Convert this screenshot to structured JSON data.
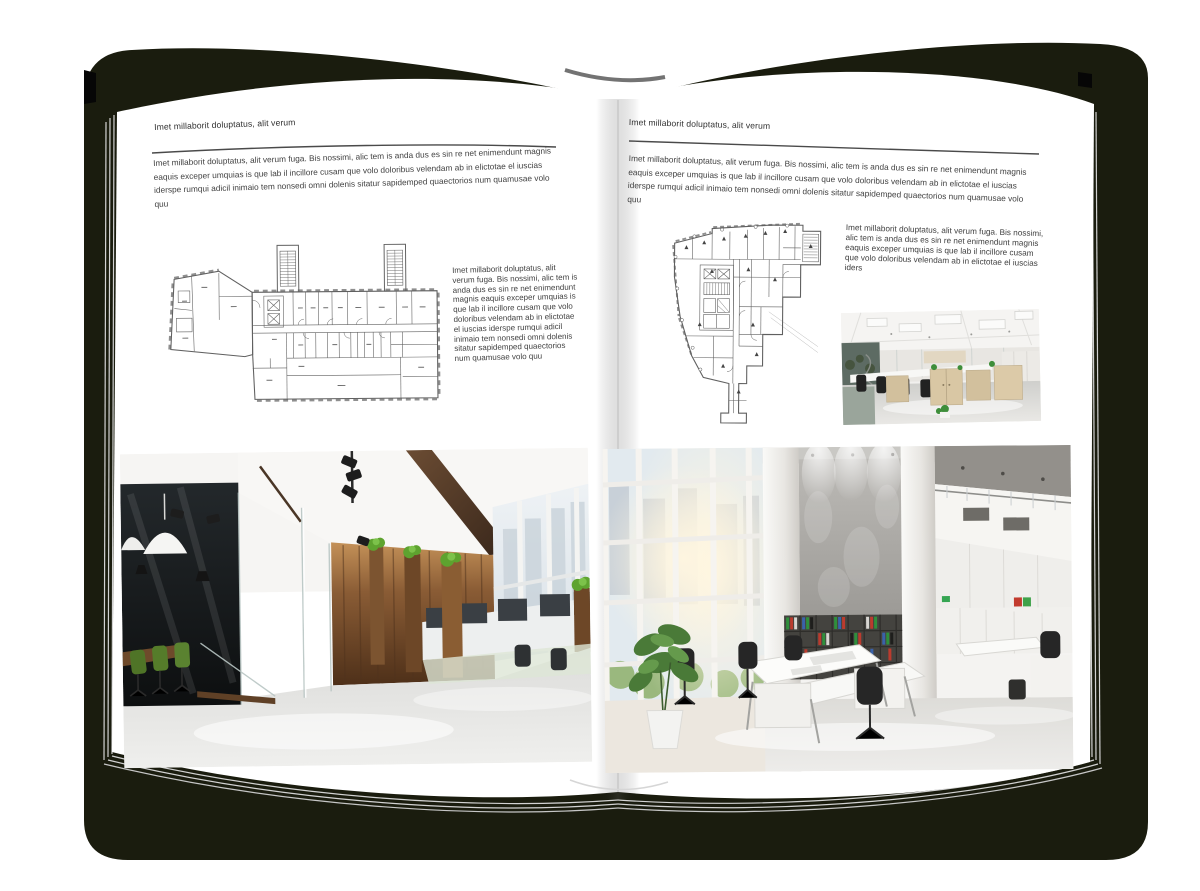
{
  "pages": {
    "left": {
      "header": "Imet millaborit doluptatus, alit verum",
      "intro": "Imet millaborit doluptatus, alit verum fuga. Bis nossimi, alic tem is anda dus es sin re net enimendunt magnis eaquis exceper umquias is que lab il incillore cusam que volo doloribus velendam ab in elictotae el iuscias iderspe rumqui adicil inimaio tem nonsedi omni dolenis sitatur sapidemped quaectorios num quamusae volo quu",
      "plan_caption": "Imet millaborit doluptatus, alit verum fuga. Bis nossimi, alic tem is anda dus es sin re net enimendunt magnis eaquis exceper umquias is que lab il incillore cusam que volo doloribus velendam ab in elictotae el iuscias iderspe rumqui adicil inimaio tem nonsedi omni dolenis sitatur sapidemped quaectorios num quamusae volo quu"
    },
    "right": {
      "header": "Imet millaborit doluptatus, alit verum",
      "intro": "Imet millaborit doluptatus, alit verum fuga. Bis nossimi, alic tem is anda dus es sin re net enimendunt magnis eaquis exceper umquias is que lab il incillore cusam que volo doloribus velendam ab in elictotae el iuscias iderspe rumqui adicil inimaio tem nonsedi omni dolenis sitatur sapidemped quaectorios num quamusae volo quu",
      "plan_caption": "Imet millaborit doluptatus, alit verum fuga. Bis nossimi, alic tem is anda dus es sin re net enimendunt magnis eaquis exceper umquias is que lab il incillore cusam que volo doloribus velendam ab in elictotae el iuscias iders"
    }
  },
  "colors": {
    "backdrop": "#1a1c0e",
    "page": "#ffffff",
    "rule": "#4a4a4a",
    "body_text": "#404040",
    "plan_stroke": "#606060"
  }
}
